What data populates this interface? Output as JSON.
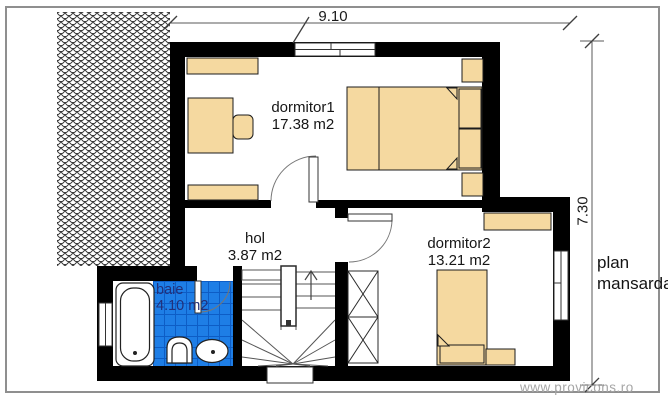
{
  "plan_title": {
    "line1": "plan",
    "line2": "mansarda"
  },
  "dimensions": {
    "top_width_m": "9.10",
    "right_height_m": "7.30"
  },
  "rooms": [
    {
      "name": "dormitor1",
      "area": "17.38 m2"
    },
    {
      "name": "dormitor2",
      "area": "13.21 m2"
    },
    {
      "name": "hol",
      "area": "3.87 m2"
    },
    {
      "name": "baie",
      "area": "4.10 m2"
    }
  ],
  "watermark": "www.provicons.ro",
  "colors": {
    "wall": "#000000",
    "furniture": "#f5d9a0",
    "bathroom_tile": "#1e7ee6",
    "tile_grid": "#0d5dc6",
    "baie_text": "#22307a",
    "linework": "#555555",
    "label_text": "#161616",
    "watermark_text": "#a6a6a6",
    "page_border": "#8f8f8f"
  }
}
